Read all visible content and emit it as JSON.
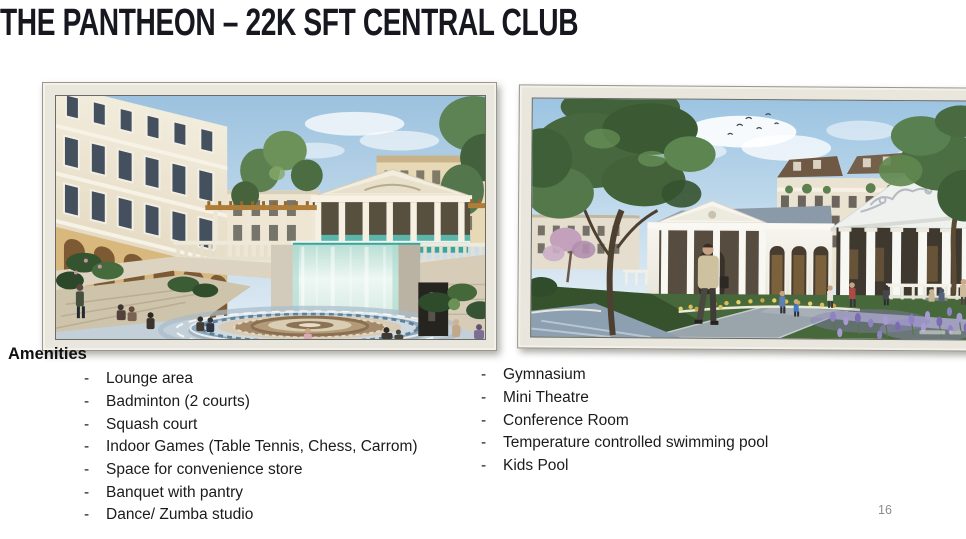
{
  "slide": {
    "title": "THE PANTHEON – 22K SFT CENTRAL CLUB",
    "page_number": "16"
  },
  "amenities": {
    "heading": "Amenities",
    "bullet": "-",
    "left_items": [
      "Lounge area",
      "Badminton (2 courts)",
      "Squash court",
      "Indoor Games (Table Tennis, Chess, Carrom)",
      "Space for convenience store",
      "Banquet with pantry",
      "Dance/ Zumba studio"
    ],
    "right_items": [
      "Gymnasium",
      "Mini Theatre",
      "Conference Room",
      "Temperature controlled swimming pool",
      "Kids Pool"
    ]
  },
  "colors": {
    "slide_background": "#ffffff",
    "title_text": "#17171f",
    "body_text": "#1b1b1b",
    "page_number": "#8c8c8c",
    "photo_frame": "#e9e6de",
    "photo_frame_border": "#9b978c"
  }
}
